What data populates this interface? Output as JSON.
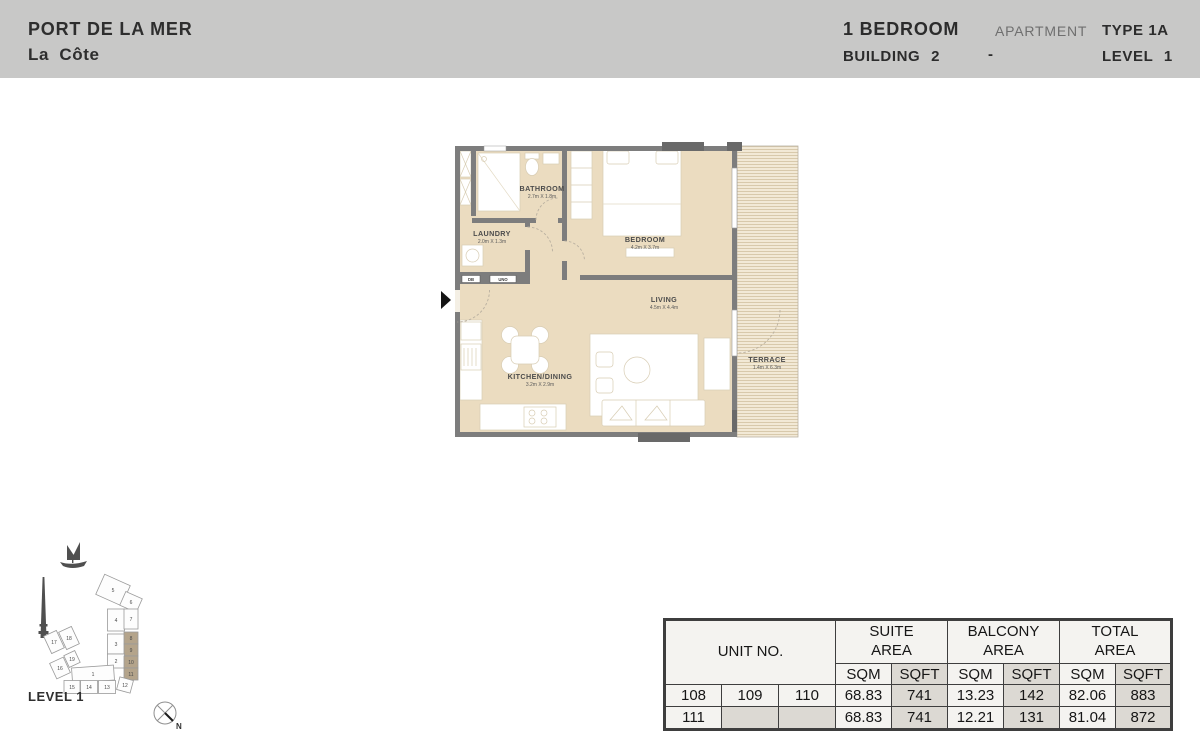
{
  "header": {
    "project": "PORT DE LA MER",
    "subproject": "La Côte",
    "unit_type": "1 BEDROOM",
    "apartment_label": "APARTMENT",
    "apartment_type": "TYPE 1A",
    "building": "BUILDING 2",
    "separator": "-",
    "level": "LEVEL 1"
  },
  "floorplan": {
    "rooms": [
      {
        "name": "BATHROOM",
        "dims": "2.7m X 1.8m"
      },
      {
        "name": "LAUNDRY",
        "dims": "2.0m X 1.3m"
      },
      {
        "name": "BEDROOM",
        "dims": "4.2m X 3.7m"
      },
      {
        "name": "LIVING",
        "dims": "4.5m X 4.4m"
      },
      {
        "name": "KITCHEN/DINING",
        "dims": "3.2m X 2.9m"
      },
      {
        "name": "TERRACE",
        "dims": "1.4m X 6.3m"
      }
    ],
    "db_label": "DB",
    "uno_label": "UNO"
  },
  "siteplan": {
    "level_label": "LEVEL 1",
    "north_label": "N",
    "blocks": [
      "1",
      "2",
      "3",
      "4",
      "5",
      "6",
      "7",
      "8",
      "9",
      "10",
      "11",
      "12",
      "13",
      "14",
      "15",
      "16",
      "17",
      "18",
      "19"
    ],
    "highlighted_blocks": [
      "8",
      "9",
      "10",
      "11"
    ]
  },
  "areas_table": {
    "unit_header": "UNIT NO.",
    "group_headers": [
      "SUITE AREA",
      "BALCONY AREA",
      "TOTAL AREA"
    ],
    "sub_headers": [
      "SQM",
      "SQFT"
    ],
    "rows": [
      [
        "108",
        "109",
        "110",
        "68.83",
        "741",
        "13.23",
        "142",
        "82.06",
        "883"
      ],
      [
        "111",
        "",
        "",
        "68.83",
        "741",
        "12.21",
        "131",
        "81.04",
        "872"
      ]
    ]
  },
  "colors": {
    "header_gray": "#c8c8c7",
    "wall_gray": "#7d7d7d",
    "floor_beige": "#ebdcc0",
    "terrace_beige": "#f2e9d6",
    "highlight_tan": "#b4a48b",
    "table_shade": "#dcd9d3"
  }
}
